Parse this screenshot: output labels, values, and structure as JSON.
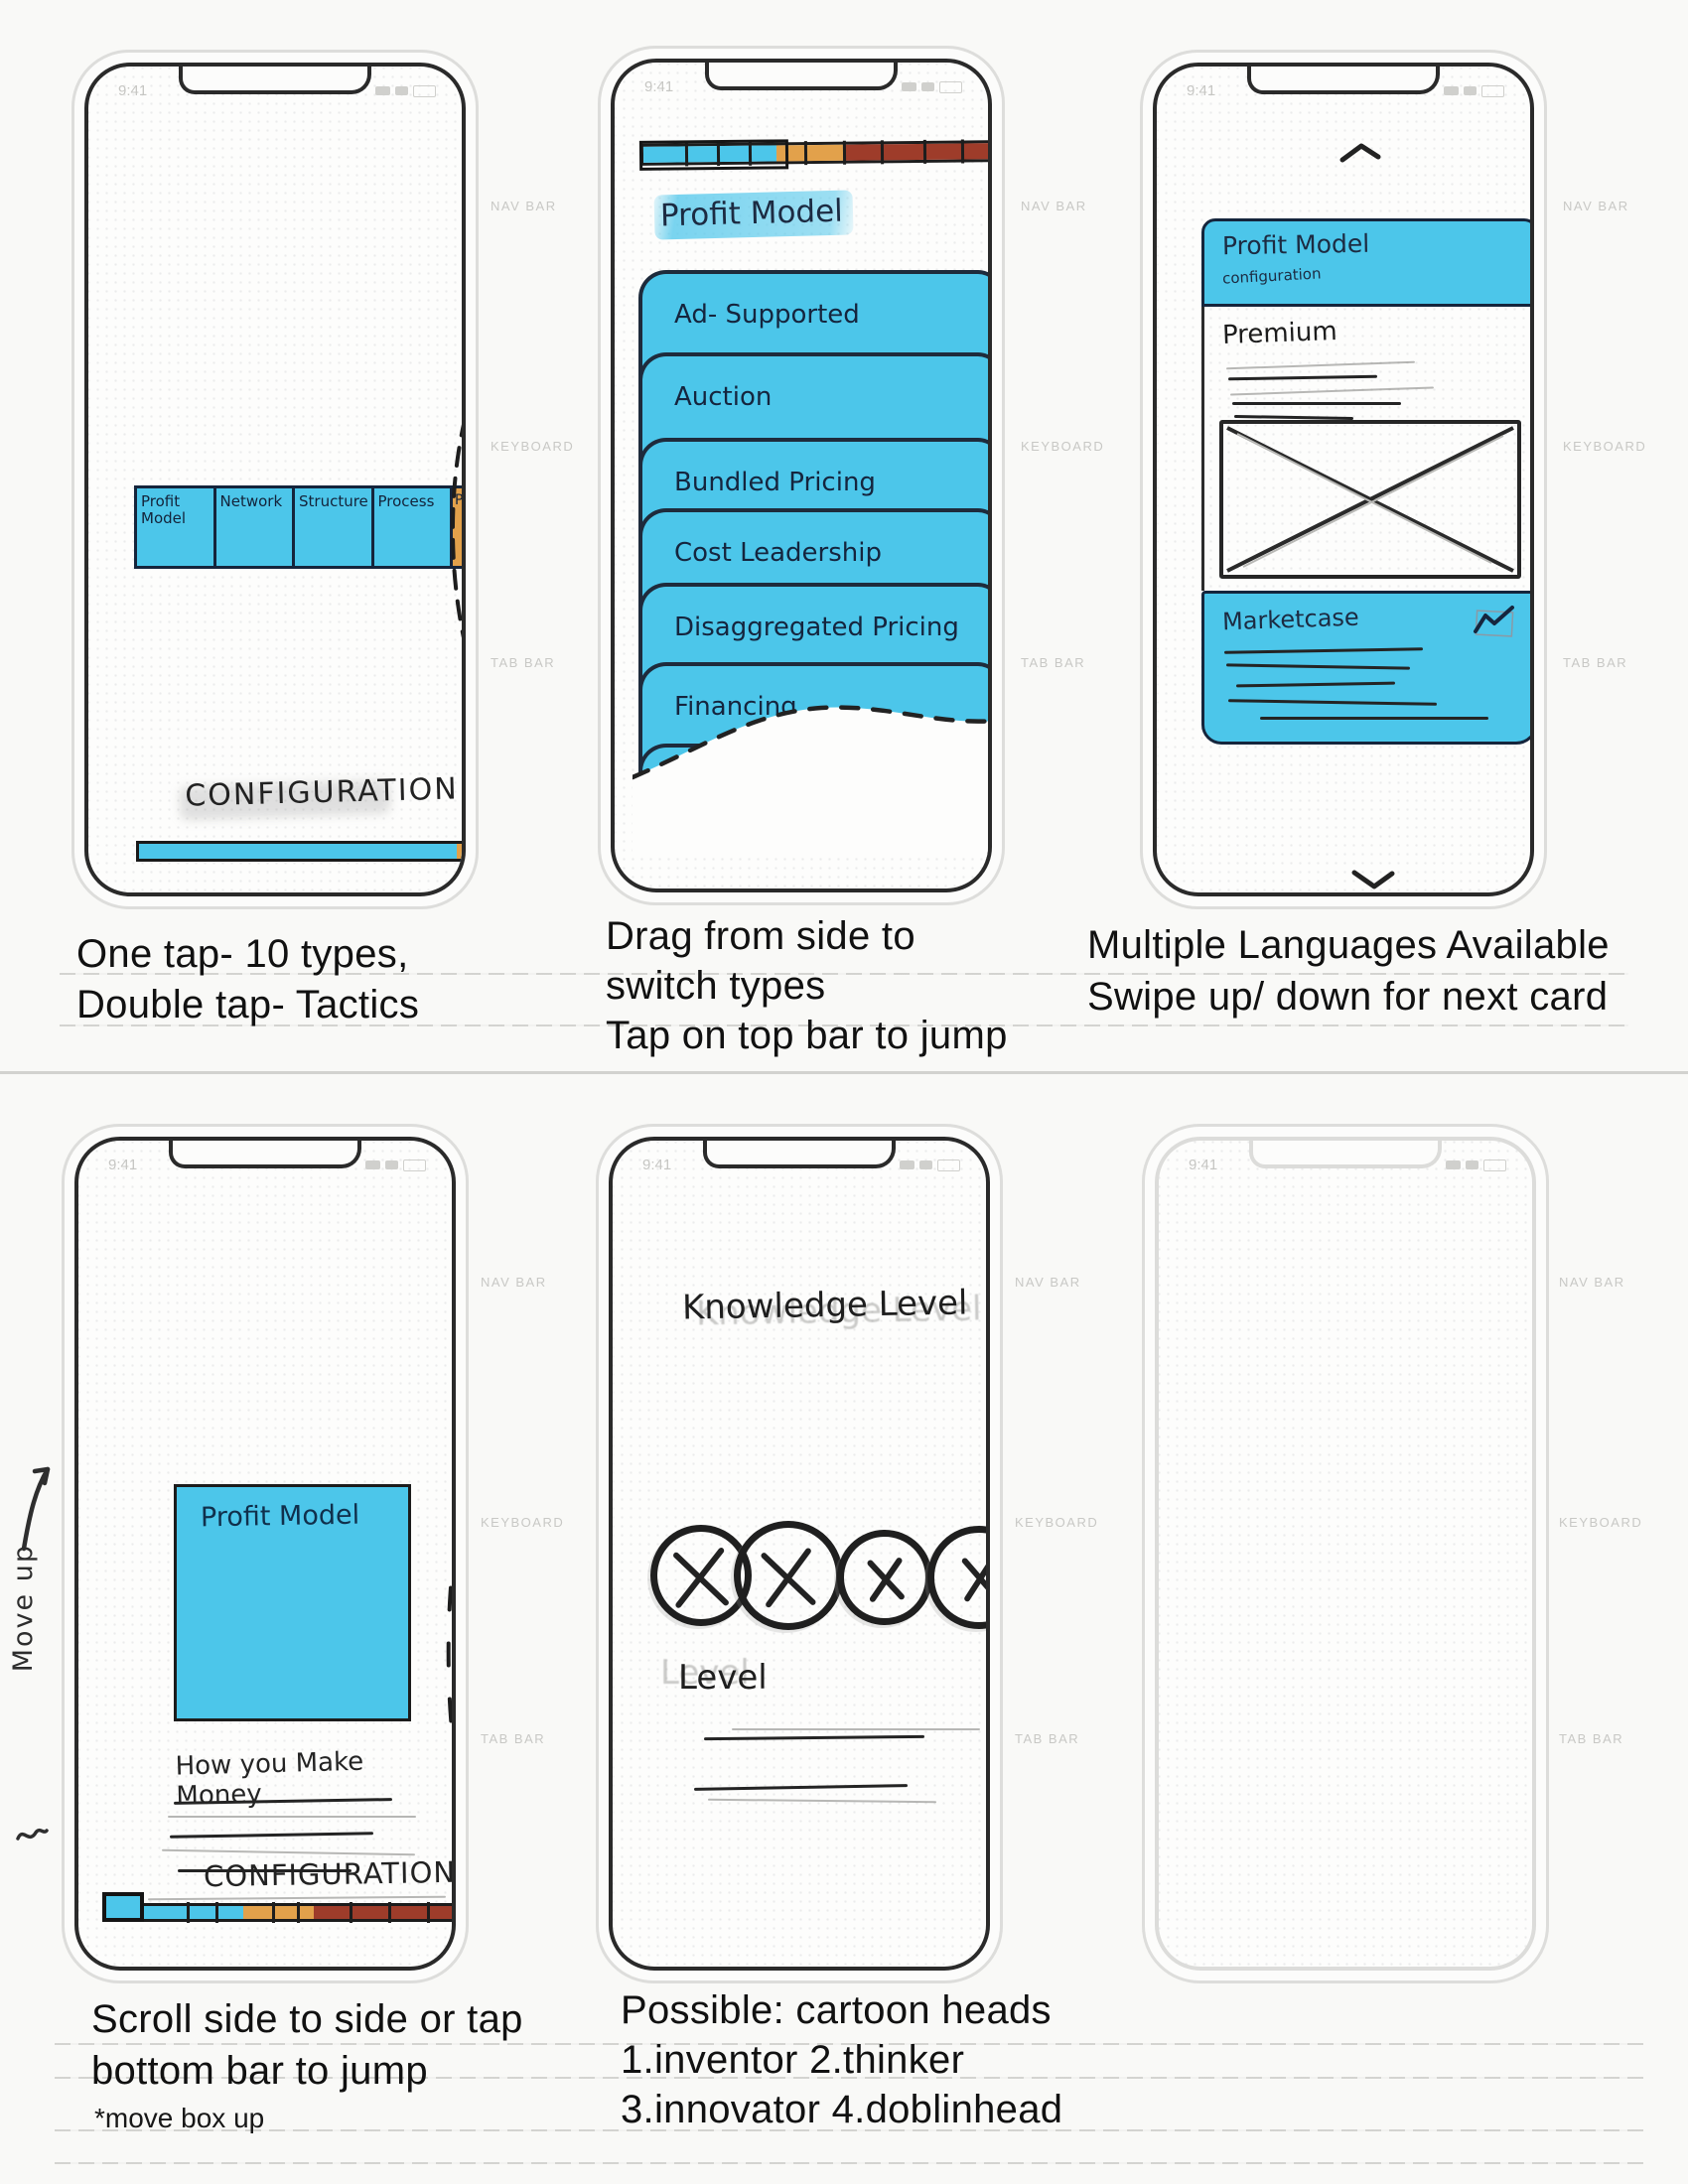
{
  "template": {
    "time": "9:41",
    "nav_bar_label": "NAV BAR",
    "keyboard_label": "KEYBOARD",
    "tab_bar_label": "TAB BAR"
  },
  "colors": {
    "marker_blue": "#4cc6ea",
    "marker_orange": "#e2a14b",
    "marker_brick": "#9e3c2a",
    "ink": "#242424",
    "navy_ink": "#15253c"
  },
  "phone1": {
    "types": [
      "Profit Model",
      "Network",
      "Structure",
      "Process",
      "Pr"
    ],
    "configuration": "CONFIGURATION",
    "caption": [
      "One tap- 10 types,",
      "Double tap- Tactics"
    ]
  },
  "phone2": {
    "title": "Profit Model",
    "cards": [
      "Ad- Supported",
      "Auction",
      "Bundled Pricing",
      "Cost Leadership",
      "Disaggregated Pricing",
      "Financing",
      "Flex"
    ],
    "caption": [
      "Drag from side to",
      "switch types",
      "Tap on top bar to jump"
    ]
  },
  "phone3": {
    "header_title": "Profit Model",
    "header_subtitle": "configuration",
    "section_title": "Premium",
    "card_title": "Marketcase",
    "caption": [
      "Multiple Languages Available",
      "Swipe up/ down for next card"
    ]
  },
  "phone4": {
    "card_title": "Profit Model",
    "subtitle": "How you Make Money",
    "configuration": "CONFIGURATION",
    "margin_note": "Move up",
    "caption": [
      "Scroll side to side or tap",
      "bottom bar to jump"
    ],
    "footnote": "*move box up"
  },
  "phone5": {
    "title": "Knowledge Level",
    "level_label": "Level",
    "caption": [
      "Possible: cartoon heads",
      "1.inventor 2.thinker",
      "3.innovator 4.doblinhead"
    ]
  }
}
